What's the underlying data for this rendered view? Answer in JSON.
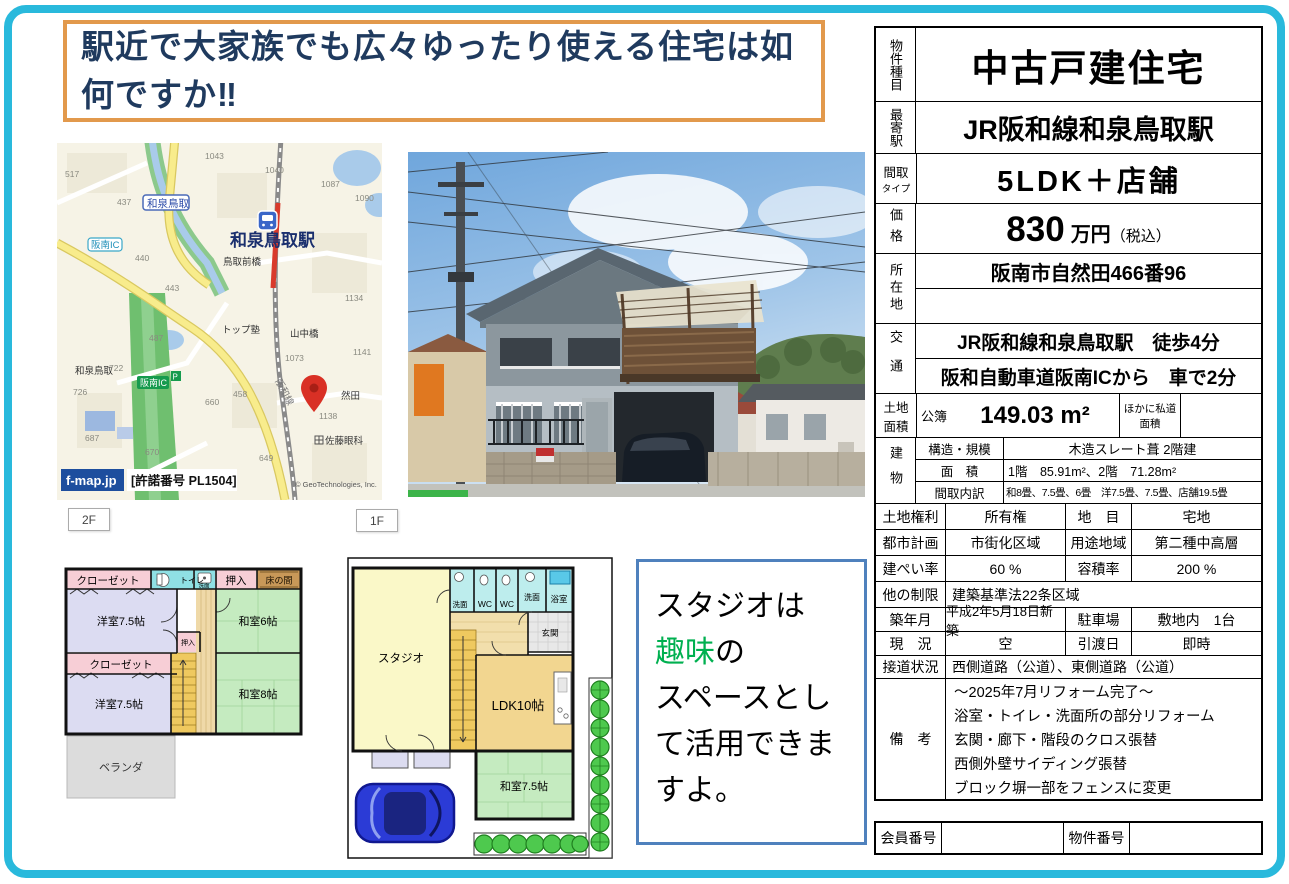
{
  "page": {
    "headline": "駅近で大家族でも広々ゆったり使える住宅は如何ですか‼"
  },
  "colors": {
    "frame_cyan": "#29B9DC",
    "headline_border_orange": "#E2994C",
    "studio_border_blue": "#4F81BD",
    "highlight_green": "#00B050",
    "map_pin_red": "#D93025"
  },
  "map": {
    "watermark": "f-map.jp",
    "license": "[許諾番号 PL1504]",
    "copyright": "© GeoTechnologies, Inc.",
    "station": "和泉鳥取駅",
    "sign_izumitottori": "和泉鳥取",
    "sign_hannan_ic": "阪南IC",
    "sign_hannan_ic2": "阪南IC",
    "label_izumitottori2": "和泉鳥取",
    "label_tottorimaebashi": "鳥取前橋",
    "label_top_juku": "トップ塾",
    "label_yamanakabashi": "山中橋",
    "label_sato_ganka": "佐藤眼科",
    "label_zenda": "然田",
    "label_hanwa_line": "阪和線",
    "numbers": [
      "517",
      "437",
      "1043",
      "1040",
      "1087",
      "1090",
      "440",
      "443",
      "487",
      "1134",
      "1073",
      "1141",
      "1138",
      "722",
      "726",
      "687",
      "670",
      "660",
      "458",
      "649"
    ]
  },
  "floors": {
    "f2": "2F",
    "f1": "1F"
  },
  "plan2f": {
    "closet1": "クローゼット",
    "toilet": "トイレ",
    "senmen": "洗面",
    "oshiire1": "押入",
    "tokonoma": "床の間",
    "yoshitsu1": "洋室7.5帖",
    "washitsu6": "和室6帖",
    "oshiire2": "押入",
    "closet2": "クローゼット",
    "yoshitsu2": "洋室7.5帖",
    "washitsu8": "和室8帖",
    "veranda": "ベランダ"
  },
  "plan1f": {
    "studio": "スタジオ",
    "senmen1": "洗面",
    "wc1": "WC",
    "wc2": "WC",
    "senmen2": "洗面",
    "bath": "浴室",
    "genkan": "玄関",
    "ldk": "LDK10帖",
    "washitsu": "和室7.5帖"
  },
  "studio_note": {
    "line1": "スタジオは",
    "highlight": "趣味",
    "line2_rest": "の",
    "line3": "スペースとして活用できますよ。"
  },
  "table": {
    "r1": {
      "label": "物件種目",
      "value": "中古戸建住宅"
    },
    "r2": {
      "label": "最寄駅",
      "value": "JR阪和線和泉鳥取駅"
    },
    "r3": {
      "label": "間取",
      "label2": "タイプ",
      "value": "5LDK＋店舗"
    },
    "r4": {
      "label": "価格",
      "number": "830",
      "unit": "万円",
      "tax": "（税込）"
    },
    "r5": {
      "label": "所在地",
      "value": "阪南市自然田466番96",
      "value2": ""
    },
    "r6": {
      "label": "交通",
      "line1": "JR阪和線和泉鳥取駅　徒歩4分",
      "line2": "阪和自動車道阪南ICから　車で2分"
    },
    "r7": {
      "label": "土地",
      "label2": "面積",
      "sub": "公簿",
      "value": "149.03 m²",
      "note": "ほかに私道面積",
      "note_value": ""
    },
    "r8": {
      "label": "建物",
      "k1": "構造・規模",
      "v1": "木造スレート葺 2階建",
      "k2": "面　積",
      "v2": "1階　85.91m²、2階　71.28m²",
      "k3": "間取内訳",
      "v3": "和8畳、7.5畳、6畳　洋7.5畳、7.5畳、店舗19.5畳"
    },
    "r9": {
      "k1": "土地権利",
      "v1": "所有権",
      "k2": "地　目",
      "v2": "宅地"
    },
    "r10": {
      "k1": "都市計画",
      "v1": "市街化区域",
      "k2": "用途地域",
      "v2": "第二種中高層"
    },
    "r11": {
      "k1": "建ぺい率",
      "v1": "60 %",
      "k2": "容積率",
      "v2": "200 %"
    },
    "r12": {
      "k": "他の制限",
      "v": "建築基準法22条区域"
    },
    "r13": {
      "k1": "築年月",
      "v1": "平成2年5月18日新築",
      "k2": "駐車場",
      "v2": "敷地内　1台"
    },
    "r14": {
      "k1": "現　況",
      "v1": "空",
      "k2": "引渡日",
      "v2": "即時"
    },
    "r15": {
      "k": "接道状況",
      "v": "西側道路（公道）、東側道路（公道）"
    },
    "r16": {
      "k": "備　考",
      "lines": [
        "～2025年7月リフォーム完了～",
        "浴室・トイレ・洗面所の部分リフォーム",
        "玄関・廊下・階段のクロス張替",
        "西側外壁サイディング張替",
        "ブロック塀一部をフェンスに変更"
      ]
    },
    "r17": {
      "k1": "会員番号",
      "v1": "",
      "k2": "物件番号",
      "v2": ""
    }
  }
}
